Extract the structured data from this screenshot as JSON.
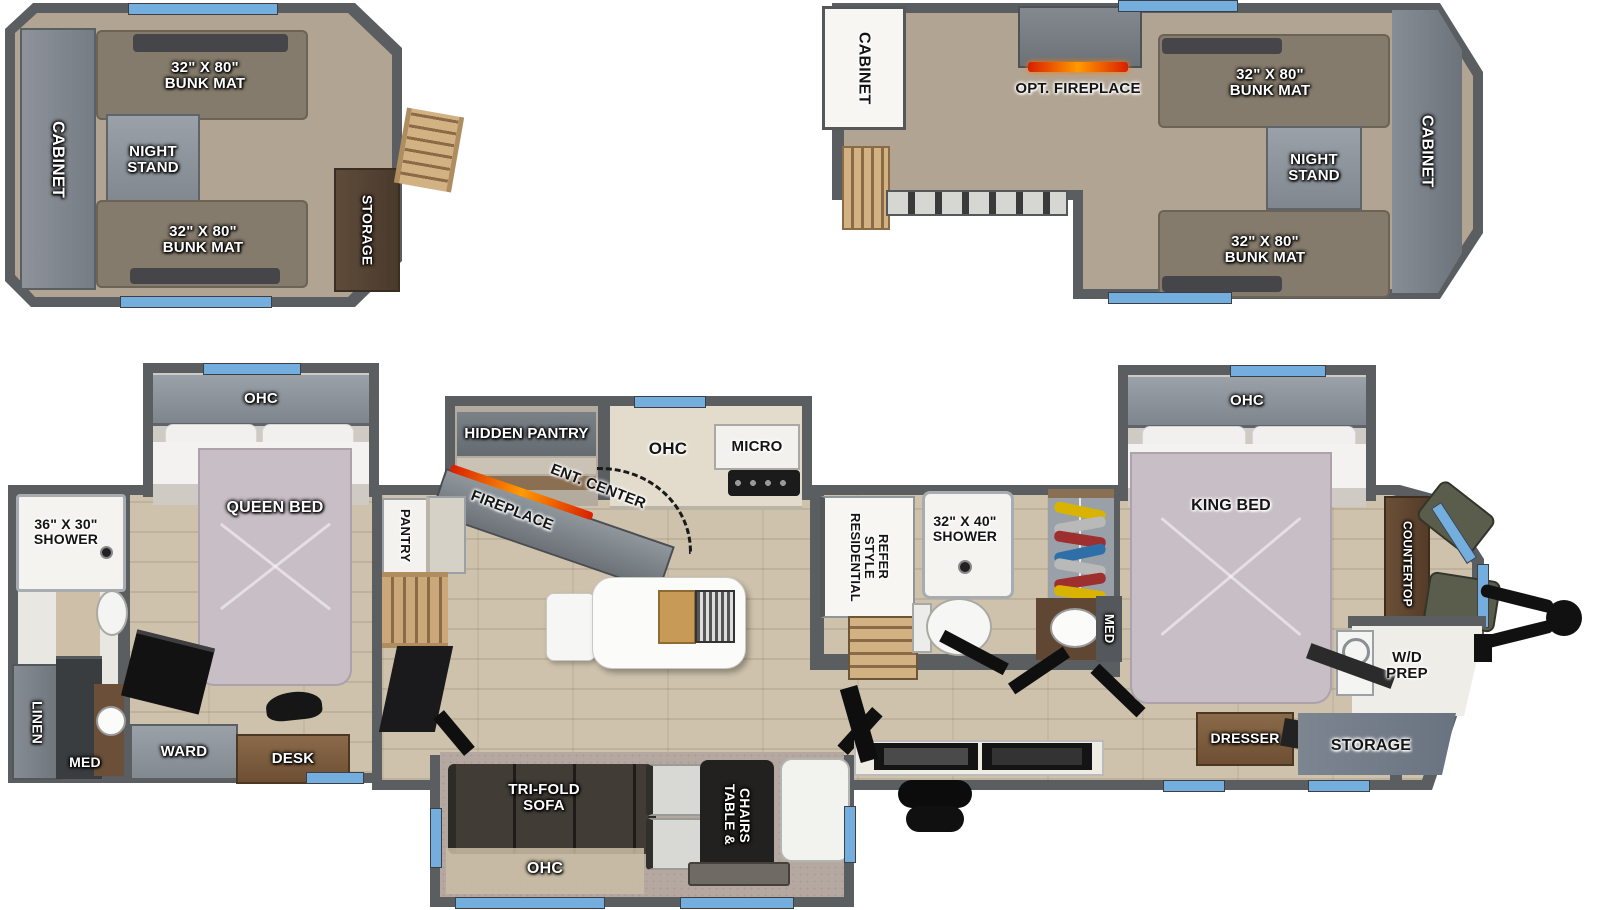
{
  "meta": {
    "title": "Travel trailer floorplan with two loft options"
  },
  "colors": {
    "wall": "#5a5e61",
    "floor_wood": "#cec2ac",
    "loft_carpet": "#b2a492",
    "slide_carpet": "#b5a8a1",
    "window_accent": "#74aede",
    "bed": "#c8bec6",
    "bunk_mat": "#857b6c",
    "flame": "#ff7a00",
    "dark_furniture": "#1b1b1d",
    "wood_stairs": "#caa87a",
    "cabinet_gray": "#8a9097"
  },
  "loft_rear": {
    "cabinet": "CABINET",
    "bunk_top": "32\" X 80\"\nBUNK MAT",
    "night_stand": "NIGHT\nSTAND",
    "bunk_bottom": "32\" X 80\"\nBUNK MAT",
    "storage": "STORAGE"
  },
  "loft_front": {
    "cabinet_left": "CABINET",
    "opt_fireplace": "OPT. FIREPLACE",
    "bunk_top": "32\" X 80\"\nBUNK MAT",
    "night_stand": "NIGHT\nSTAND",
    "bunk_bottom": "32\" X 80\"\nBUNK MAT",
    "cabinet_right": "CABINET"
  },
  "rear_bath": {
    "shower": "36\" X 30\"\nSHOWER",
    "linen": "LINEN",
    "med": "MED"
  },
  "bedroom": {
    "ohc": "OHC",
    "bed": "QUEEN BED",
    "ward": "WARD",
    "desk": "DESK"
  },
  "hall": {
    "pantry": "PANTRY"
  },
  "kitchen": {
    "hidden_pantry": "HIDDEN PANTRY",
    "fireplace": "FIREPLACE",
    "ent_center": "ENT. CENTER",
    "ohc": "OHC",
    "micro": "MICRO"
  },
  "sofa_slide": {
    "sofa": "TRI-FOLD\nSOFA",
    "ohc": "OHC",
    "table": "TABLE &\nCHAIRS"
  },
  "mid_bath": {
    "refer": "RESIDENTIAL\nSTYLE\nREFER",
    "shower": "32\" X 40\"\nSHOWER",
    "med": "MED"
  },
  "king_room": {
    "ohc": "OHC",
    "bed": "KING BED",
    "dresser": "DRESSER"
  },
  "front": {
    "countertop": "COUNTERTOP",
    "wd_prep": "W/D\nPREP",
    "storage": "STORAGE"
  }
}
